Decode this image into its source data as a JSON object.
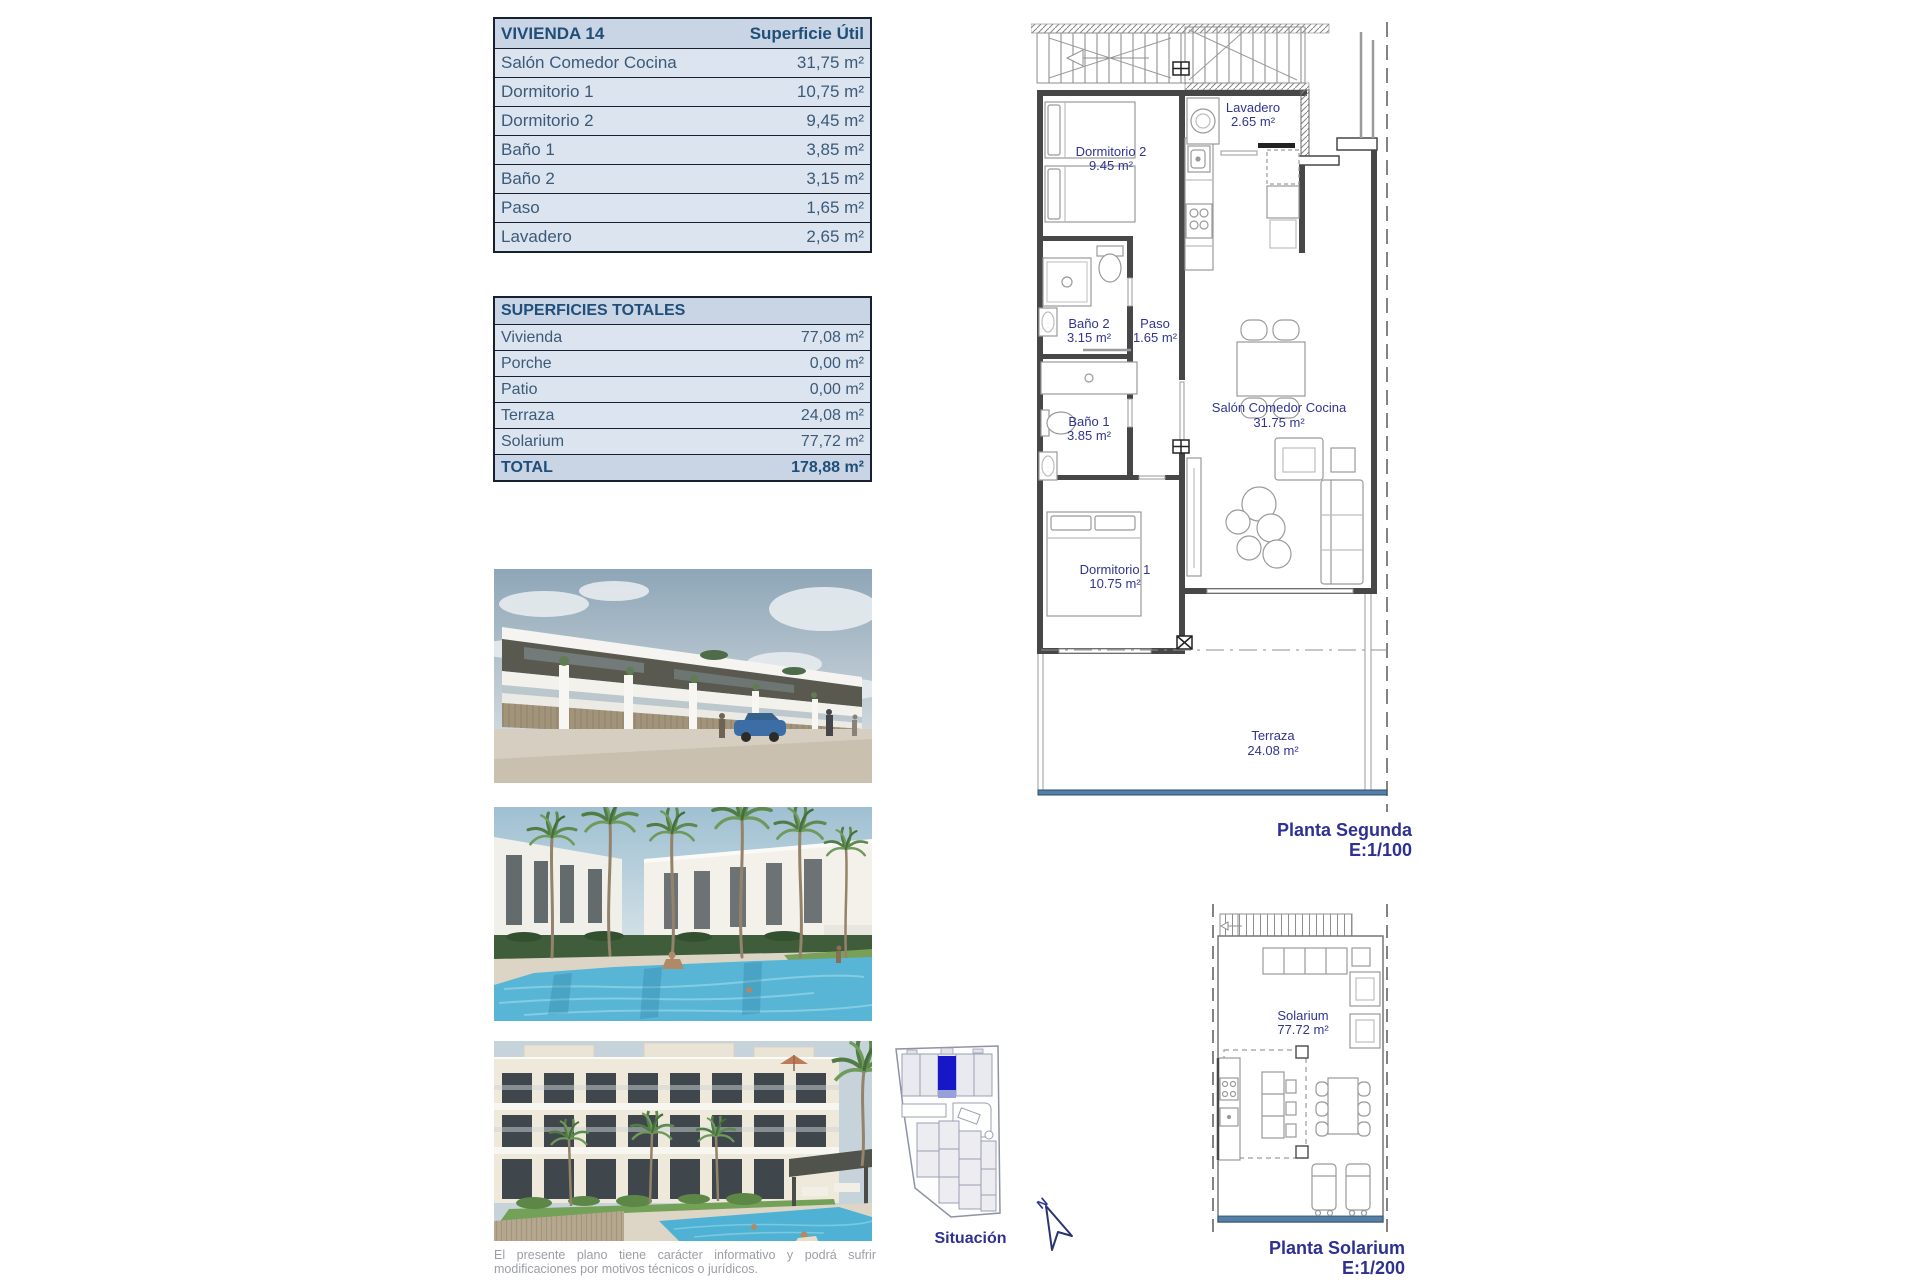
{
  "tables": {
    "vivienda": {
      "title": "VIVIENDA 14",
      "value_header": "Superficie Útil",
      "rows": [
        {
          "label": "Salón Comedor Cocina",
          "value": "31,75 m²"
        },
        {
          "label": "Dormitorio 1",
          "value": "10,75 m²"
        },
        {
          "label": "Dormitorio 2",
          "value": "9,45 m²"
        },
        {
          "label": "Baño 1",
          "value": "3,85 m²"
        },
        {
          "label": "Baño 2",
          "value": "3,15 m²"
        },
        {
          "label": "Paso",
          "value": "1,65 m²"
        },
        {
          "label": "Lavadero",
          "value": "2,65 m²"
        }
      ]
    },
    "totales": {
      "title": "SUPERFICIES TOTALES",
      "rows": [
        {
          "label": "Vivienda",
          "value": "77,08 m²"
        },
        {
          "label": "Porche",
          "value": "0,00 m²"
        },
        {
          "label": "Patio",
          "value": "0,00 m²"
        },
        {
          "label": "Terraza",
          "value": "24,08 m²"
        },
        {
          "label": "Solarium",
          "value": "77,72 m²"
        }
      ],
      "total": {
        "label": "TOTAL",
        "value": "178,88 m²"
      }
    }
  },
  "floorplan": {
    "caption": "Planta Segunda",
    "scale": "E:1/100",
    "rooms": {
      "dormitorio2": {
        "name": "Dormitorio 2",
        "area": "9.45 m²"
      },
      "lavadero": {
        "name": "Lavadero",
        "area": "2.65 m²"
      },
      "bano2": {
        "name": "Baño 2",
        "area": "3.15 m²"
      },
      "paso": {
        "name": "Paso",
        "area": "1.65 m²"
      },
      "salon": {
        "name": "Salón Comedor Cocina",
        "area": "31.75 m²"
      },
      "bano1": {
        "name": "Baño 1",
        "area": "3.85 m²"
      },
      "dormitorio1": {
        "name": "Dormitorio 1",
        "area": "10.75 m²"
      },
      "terraza": {
        "name": "Terraza",
        "area": "24.08 m²"
      }
    }
  },
  "solarium_plan": {
    "caption": "Planta Solarium",
    "scale": "E:1/200",
    "rooms": {
      "solarium": {
        "name": "Solarium",
        "area": "77.72 m²"
      }
    }
  },
  "situacion": {
    "caption": "Situación",
    "north": "N"
  },
  "disclaimer": "El presente plano tiene carácter informativo y podrá sufrir modificaciones por motivos técnicos o jurídicos.",
  "colors": {
    "accent_navy": "#2e3192",
    "table_header_bg": "#c9d5e5",
    "table_row_bg": "#dce4f0",
    "table_border": "#16202e",
    "highlight_unit_blue": "#1717c9",
    "highlight_unit_lightblue": "#98a0da",
    "terrace_rail_blue": "#567fa6",
    "pool_blue": "#58b5d6"
  }
}
